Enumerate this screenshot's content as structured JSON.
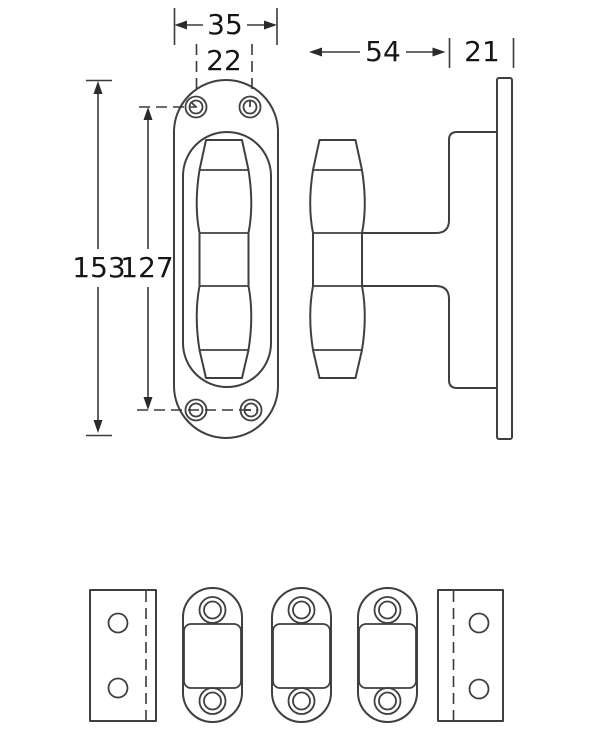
{
  "drawing": {
    "type": "technical-drawing",
    "subject": "door-handle-hardware-with-oval-rosette",
    "dimensions": {
      "rosette_width": "35",
      "screw_hole_spacing_horizontal": "22",
      "handle_projection": "54",
      "mount_depth": "21",
      "rosette_height": "153",
      "screw_hole_spacing_vertical": "127"
    },
    "colors": {
      "line": "#3f3f3f",
      "text": "#161616",
      "background": "#ffffff"
    },
    "views": {
      "front_view": "oval rosette with spindle handle, four screw holes",
      "side_view": "handle grip on stem mounted to backplate",
      "bottom_parts": [
        "mounting plate left",
        "spacer 1",
        "spacer 2",
        "spacer 3",
        "mounting plate right"
      ]
    }
  }
}
